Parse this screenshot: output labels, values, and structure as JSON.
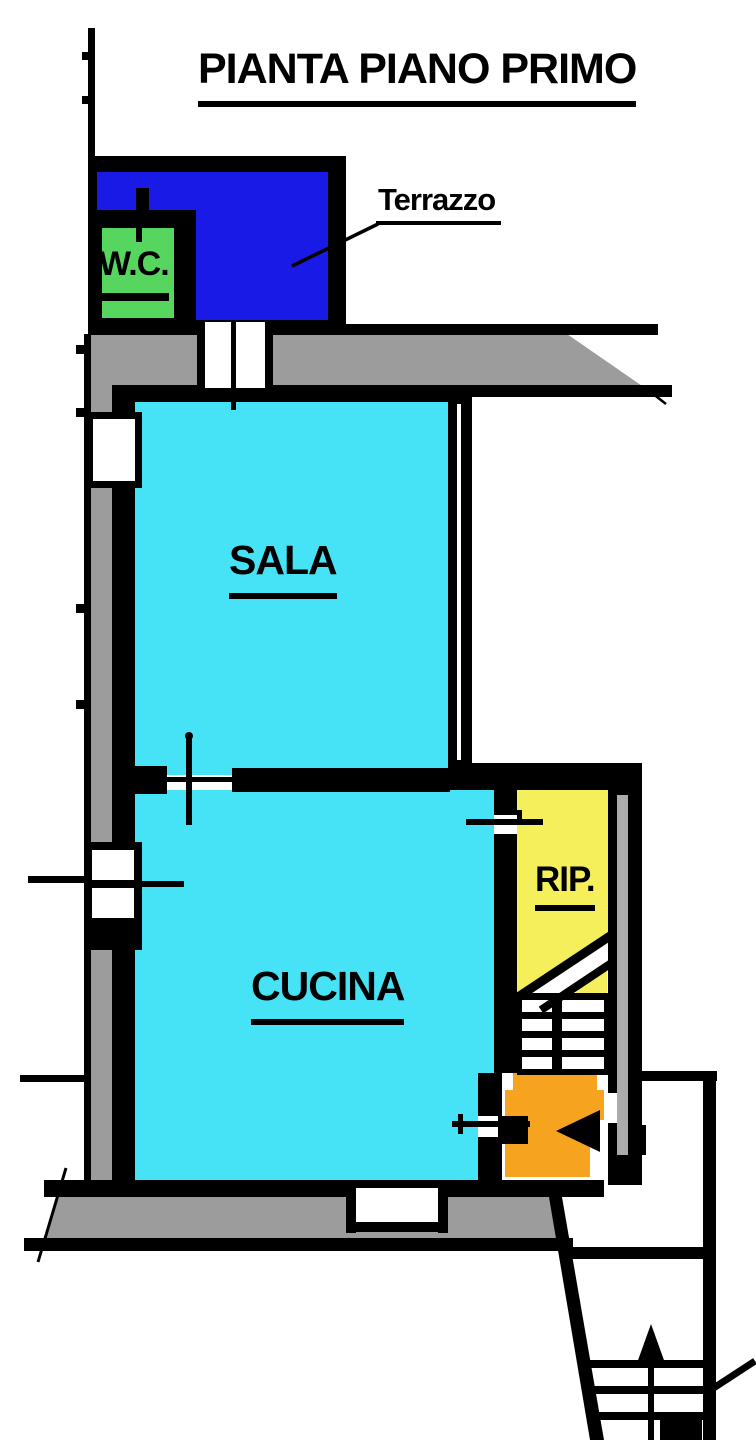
{
  "title": "PIANTA PIANO PRIMO",
  "labels": {
    "terrazzo": "Terrazzo",
    "wc": "W.C.",
    "sala": "SALA",
    "cucina": "CUCINA",
    "rip": "RIP."
  },
  "colors": {
    "wall": "#000000",
    "background": "#ffffff",
    "masonry": "#9c9c9c",
    "masonry_light": "#ababab",
    "terrazzo": "#1a1ae6",
    "wc": "#57d65f",
    "sala": "#46e2f5",
    "cucina": "#46e2f5",
    "rip": "#f4ef5a",
    "landing": "#f6a41f"
  }
}
